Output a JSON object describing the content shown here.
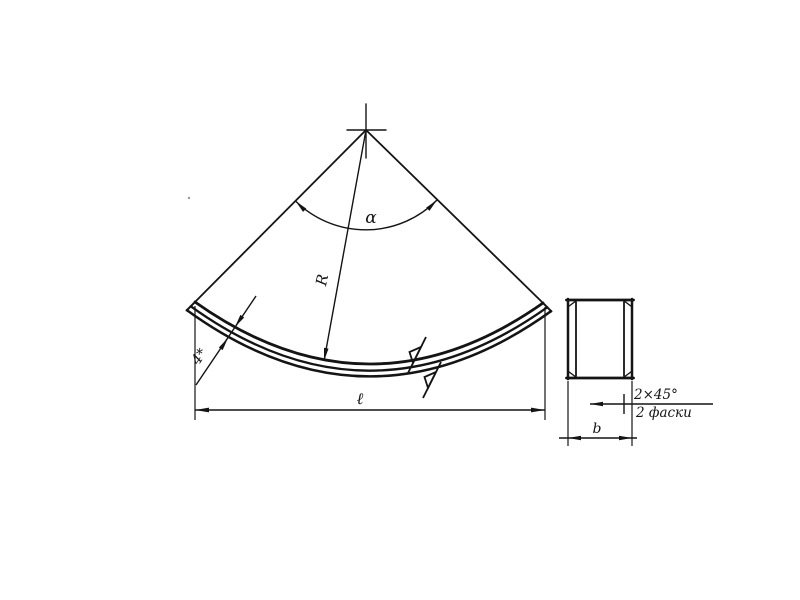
{
  "drawing": {
    "type": "technical-drawing",
    "subject": "curved strip (arc segment) with cross-section view",
    "labels": {
      "angle": "α",
      "radius": "R",
      "thickness": "4*",
      "length": "ℓ",
      "width": "b",
      "chamfer_size": "2×45°",
      "chamfer_note": "2 фаски"
    },
    "colors": {
      "background": "#ffffff",
      "line": "#141414"
    }
  }
}
